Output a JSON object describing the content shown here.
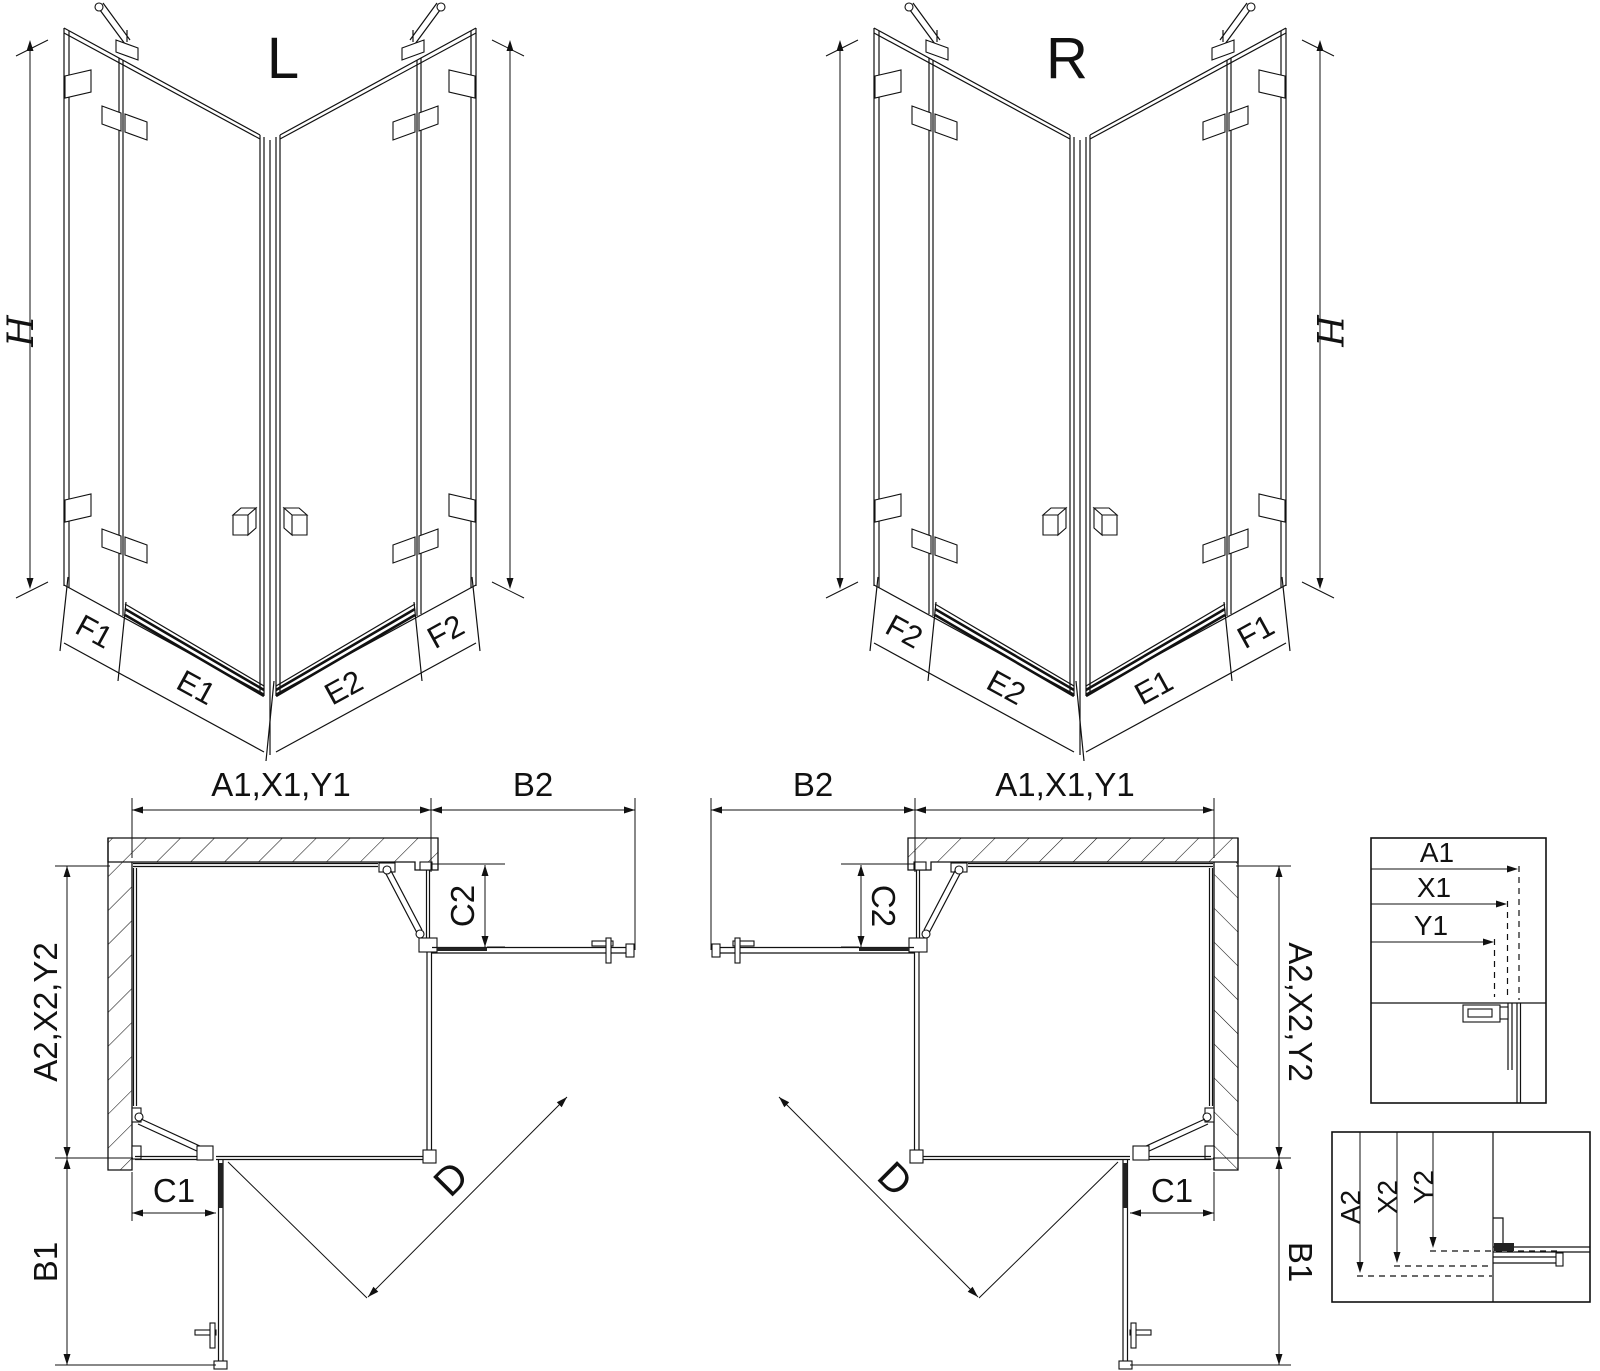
{
  "colors": {
    "line": "#111111",
    "background": "#ffffff",
    "seal": "#222222"
  },
  "perspective": {
    "left": {
      "title": "L",
      "height_label": "H",
      "base_labels": [
        "F1",
        "E1",
        "E2",
        "F2"
      ]
    },
    "right": {
      "title": "R",
      "height_label": "H",
      "base_labels": [
        "F2",
        "E2",
        "E1",
        "F1"
      ]
    }
  },
  "plan": {
    "left": {
      "width_label": "A1,X1,Y1",
      "open_top_label": "B2",
      "side_label": "A2,X2,Y2",
      "fixed_top_label": "C2",
      "fixed_bottom_label": "C1",
      "open_bottom_label": "B1",
      "diagonal_label": "D"
    },
    "right": {
      "width_label": "A1,X1,Y1",
      "open_top_label": "B2",
      "side_label": "A2,X2,Y2",
      "fixed_top_label": "C2",
      "fixed_bottom_label": "C1",
      "open_bottom_label": "B1",
      "diagonal_label": "D"
    }
  },
  "details": {
    "horizontal": {
      "labels": [
        "A1",
        "X1",
        "Y1"
      ]
    },
    "vertical": {
      "labels": [
        "A2",
        "X2",
        "Y2"
      ]
    }
  }
}
